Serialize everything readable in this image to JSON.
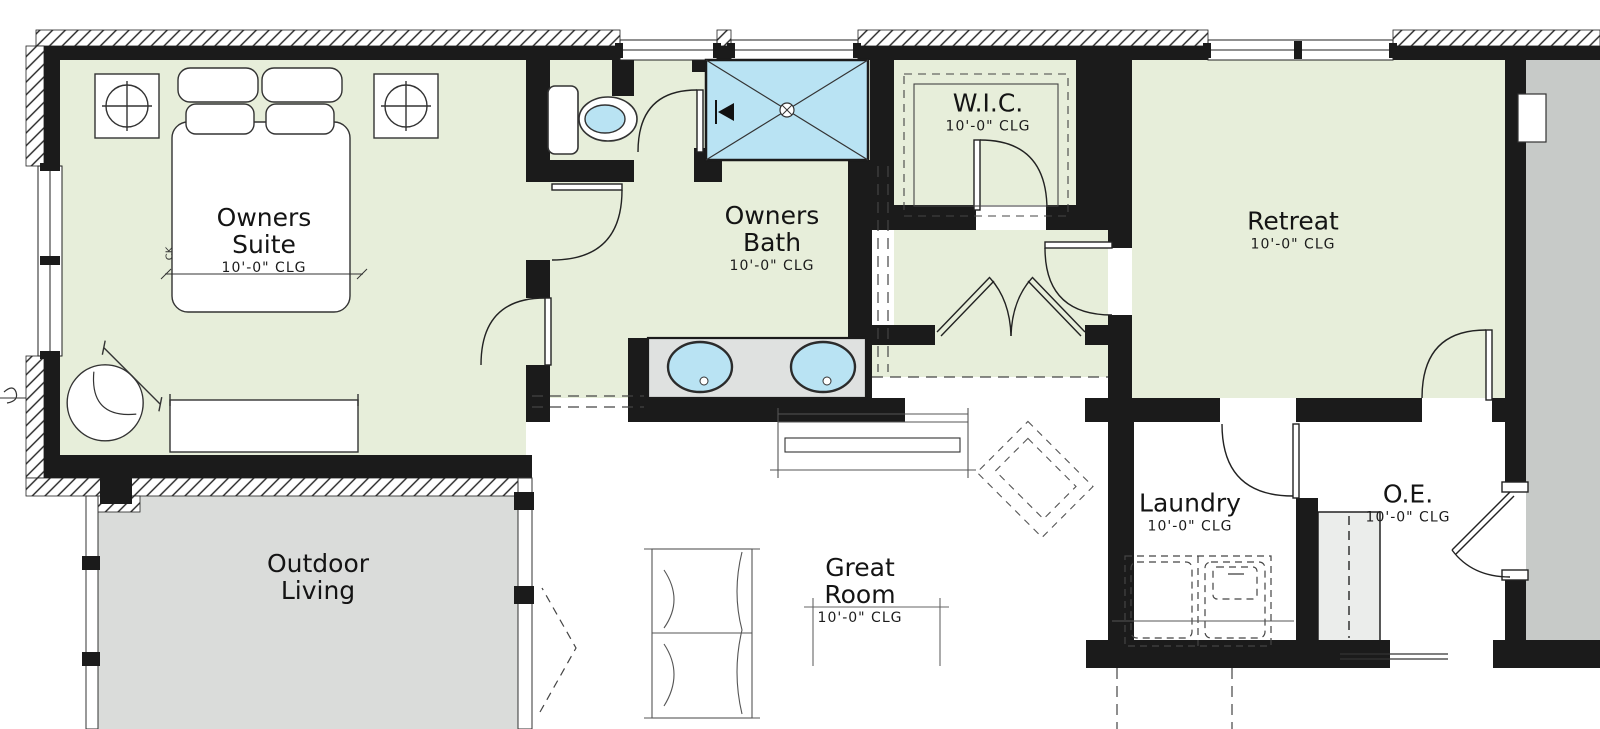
{
  "plan_title": "Owners Suite Floor Plan",
  "colors": {
    "room_green": "#e7eeda",
    "water_blue": "#b9e3f3",
    "counter_gray": "#dfe1e0",
    "outdoor_gray": "#dadcda",
    "adjacent_gray": "#c7cac8",
    "cabinet_gray": "#ebedeb",
    "wall_black": "#1b1b1b"
  },
  "rooms": [
    {
      "id": "owners-suite",
      "name": "Owners Suite",
      "ceiling": "10'-0\" CLG"
    },
    {
      "id": "owners-bath",
      "name": "Owners Bath",
      "ceiling": "10'-0\" CLG"
    },
    {
      "id": "wic",
      "name": "W.I.C.",
      "ceiling": "10'-0\" CLG"
    },
    {
      "id": "retreat",
      "name": "Retreat",
      "ceiling": "10'-0\" CLG"
    },
    {
      "id": "outdoor-living",
      "name": "Outdoor Living",
      "ceiling": ""
    },
    {
      "id": "great-room",
      "name": "Great Room",
      "ceiling": "10'-0\" CLG"
    },
    {
      "id": "laundry",
      "name": "Laundry",
      "ceiling": "10'-0\" CLG"
    },
    {
      "id": "owners-entry",
      "name": "O.E.",
      "ceiling": "10'-0\" CLG"
    }
  ],
  "annotations": {
    "bed_label": "CK"
  },
  "fixtures": [
    "king-bed",
    "nightstand-left",
    "nightstand-right",
    "table-lamp-left",
    "table-lamp-right",
    "accent-chair",
    "bench",
    "toilet",
    "walk-in-shower",
    "shower-drain",
    "shower-valve",
    "double-vanity",
    "sink-left",
    "sink-right",
    "double-doors",
    "washer",
    "dryer",
    "loveseat",
    "console-table",
    "dashed-armchair",
    "entry-door",
    "wall-niche"
  ]
}
